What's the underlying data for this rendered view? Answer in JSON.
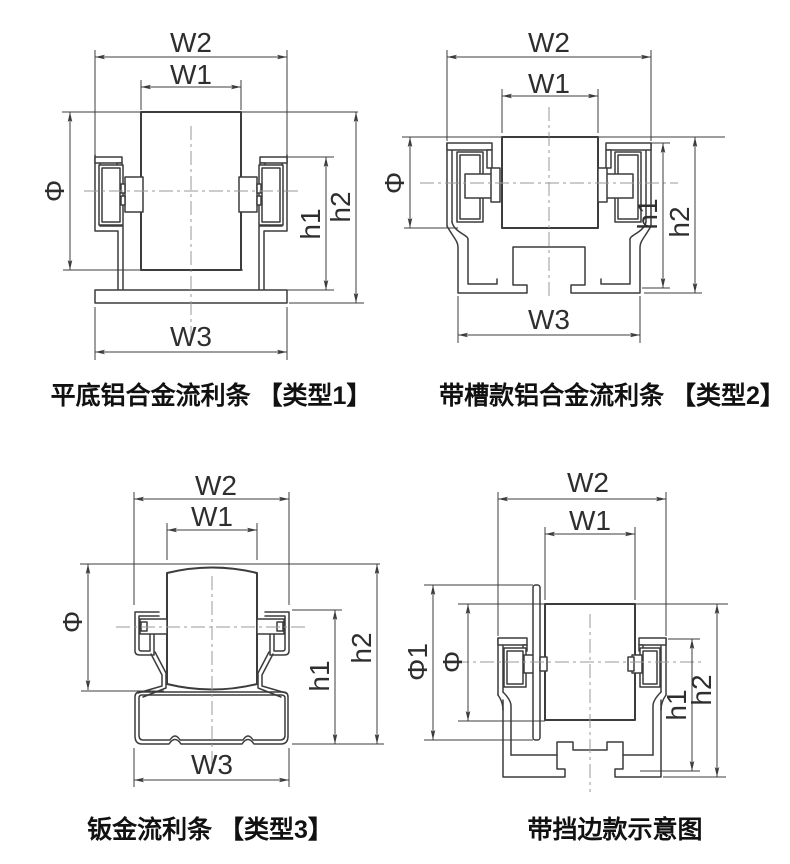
{
  "sheet": {
    "width": 790,
    "height": 864,
    "background": "#ffffff"
  },
  "colors": {
    "outline": "#3c3c3c",
    "dimension_line": "#3c3c3c",
    "centerline": "#9a9a9a",
    "dimension_text": "#2e2e2e",
    "caption_text": "#111111"
  },
  "diagrams": [
    {
      "id": "type-1",
      "caption": "平底铝合金流利条 【类型1】",
      "labels": {
        "w2": "W2",
        "w1": "W1",
        "w3": "W3",
        "phi": "Φ",
        "h1": "h1",
        "h2": "h2"
      }
    },
    {
      "id": "type-2",
      "caption": "带槽款铝合金流利条 【类型2】",
      "labels": {
        "w2": "W2",
        "w1": "W1",
        "w3": "W3",
        "phi": "Φ",
        "h1": "h1",
        "h2": "h2"
      }
    },
    {
      "id": "type-3",
      "caption": "钣金流利条 【类型3】",
      "labels": {
        "w2": "W2",
        "w1": "W1",
        "w3": "W3",
        "phi": "Φ",
        "h1": "h1",
        "h2": "h2"
      }
    },
    {
      "id": "type-4",
      "caption": "带挡边款示意图",
      "labels": {
        "w2": "W2",
        "w1": "W1",
        "phi1": "Φ1",
        "phi": "Φ",
        "h1": "h1",
        "h2": "h2"
      }
    }
  ]
}
